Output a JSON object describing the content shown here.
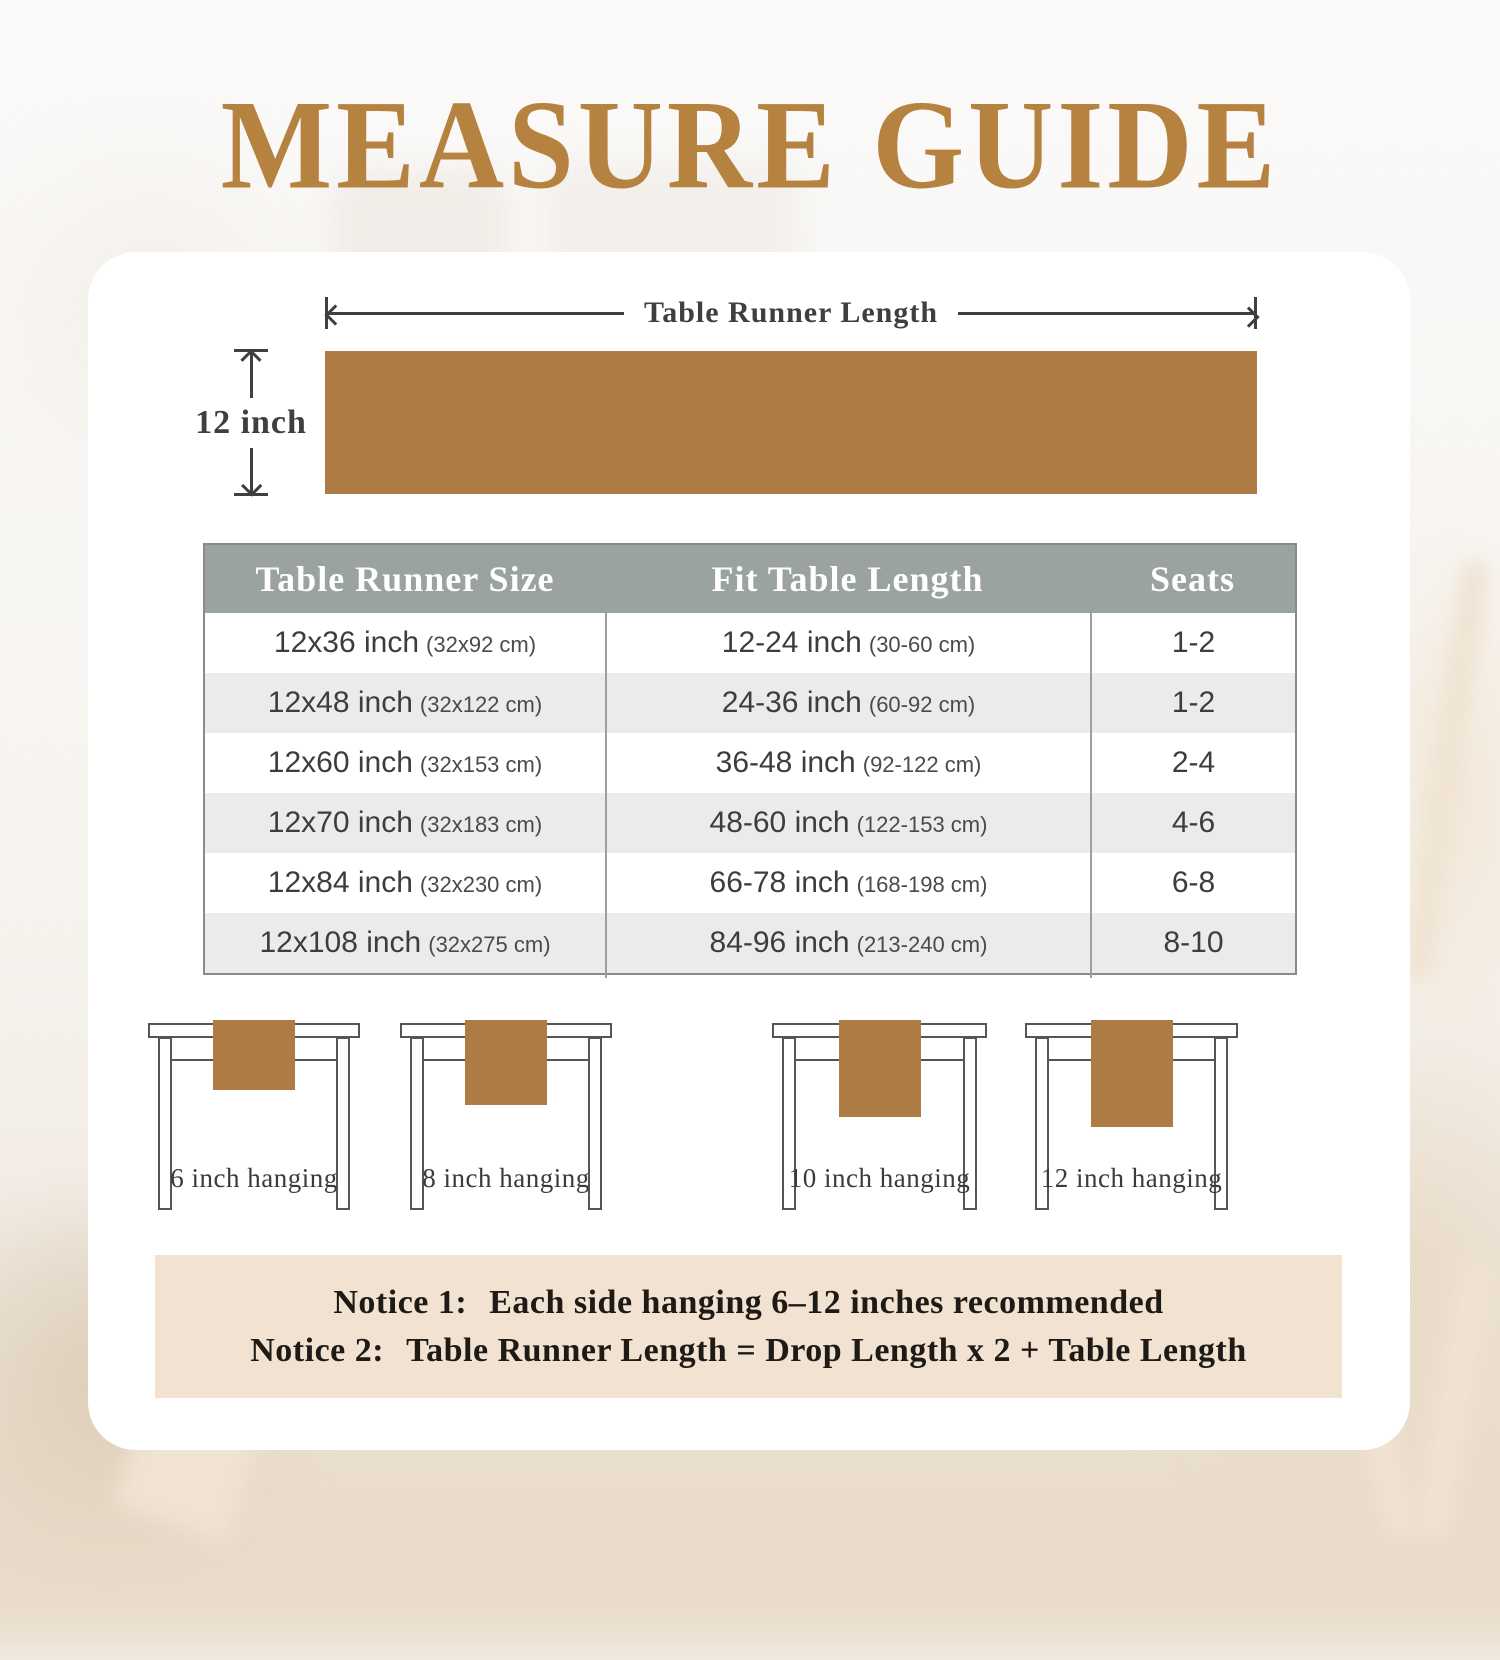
{
  "page": {
    "title": "MEASURE GUIDE"
  },
  "diagram": {
    "length_label": "Table Runner Length",
    "width_label": "12 inch"
  },
  "size_table": {
    "headers": [
      "Table Runner Size",
      "Fit Table Length",
      "Seats"
    ],
    "rows": [
      {
        "size": "12x36 inch",
        "size_cm": "(32x92 cm)",
        "fit": "12-24 inch",
        "fit_cm": "(30-60 cm)",
        "seats": "1-2"
      },
      {
        "size": "12x48 inch",
        "size_cm": "(32x122 cm)",
        "fit": "24-36 inch",
        "fit_cm": "(60-92 cm)",
        "seats": "1-2"
      },
      {
        "size": "12x60 inch",
        "size_cm": "(32x153 cm)",
        "fit": "36-48 inch",
        "fit_cm": "(92-122 cm)",
        "seats": "2-4"
      },
      {
        "size": "12x70 inch",
        "size_cm": "(32x183 cm)",
        "fit": "48-60 inch",
        "fit_cm": "(122-153 cm)",
        "seats": "4-6"
      },
      {
        "size": "12x84 inch",
        "size_cm": "(32x230 cm)",
        "fit": "66-78 inch",
        "fit_cm": "(168-198 cm)",
        "seats": "6-8"
      },
      {
        "size": "12x108 inch",
        "size_cm": "(32x275 cm)",
        "fit": "84-96 inch",
        "fit_cm": "(213-240 cm)",
        "seats": "8-10"
      }
    ]
  },
  "hanging": [
    {
      "label": "6 inch hanging"
    },
    {
      "label": "8 inch hanging"
    },
    {
      "label": "10 inch hanging"
    },
    {
      "label": "12 inch hanging"
    }
  ],
  "notices": [
    {
      "label": "Notice 1:",
      "text": "Each side hanging 6–12 inches recommended"
    },
    {
      "label": "Notice 2:",
      "text": "Table Runner Length = Drop Length x 2 + Table Length"
    }
  ],
  "colors": {
    "accent_gold": "#b5823f",
    "runner_brown": "#ae7b45",
    "table_header_gray": "#9aa3a0",
    "row_alt_gray": "#ebebed",
    "notice_beige": "#f2e2d1"
  }
}
